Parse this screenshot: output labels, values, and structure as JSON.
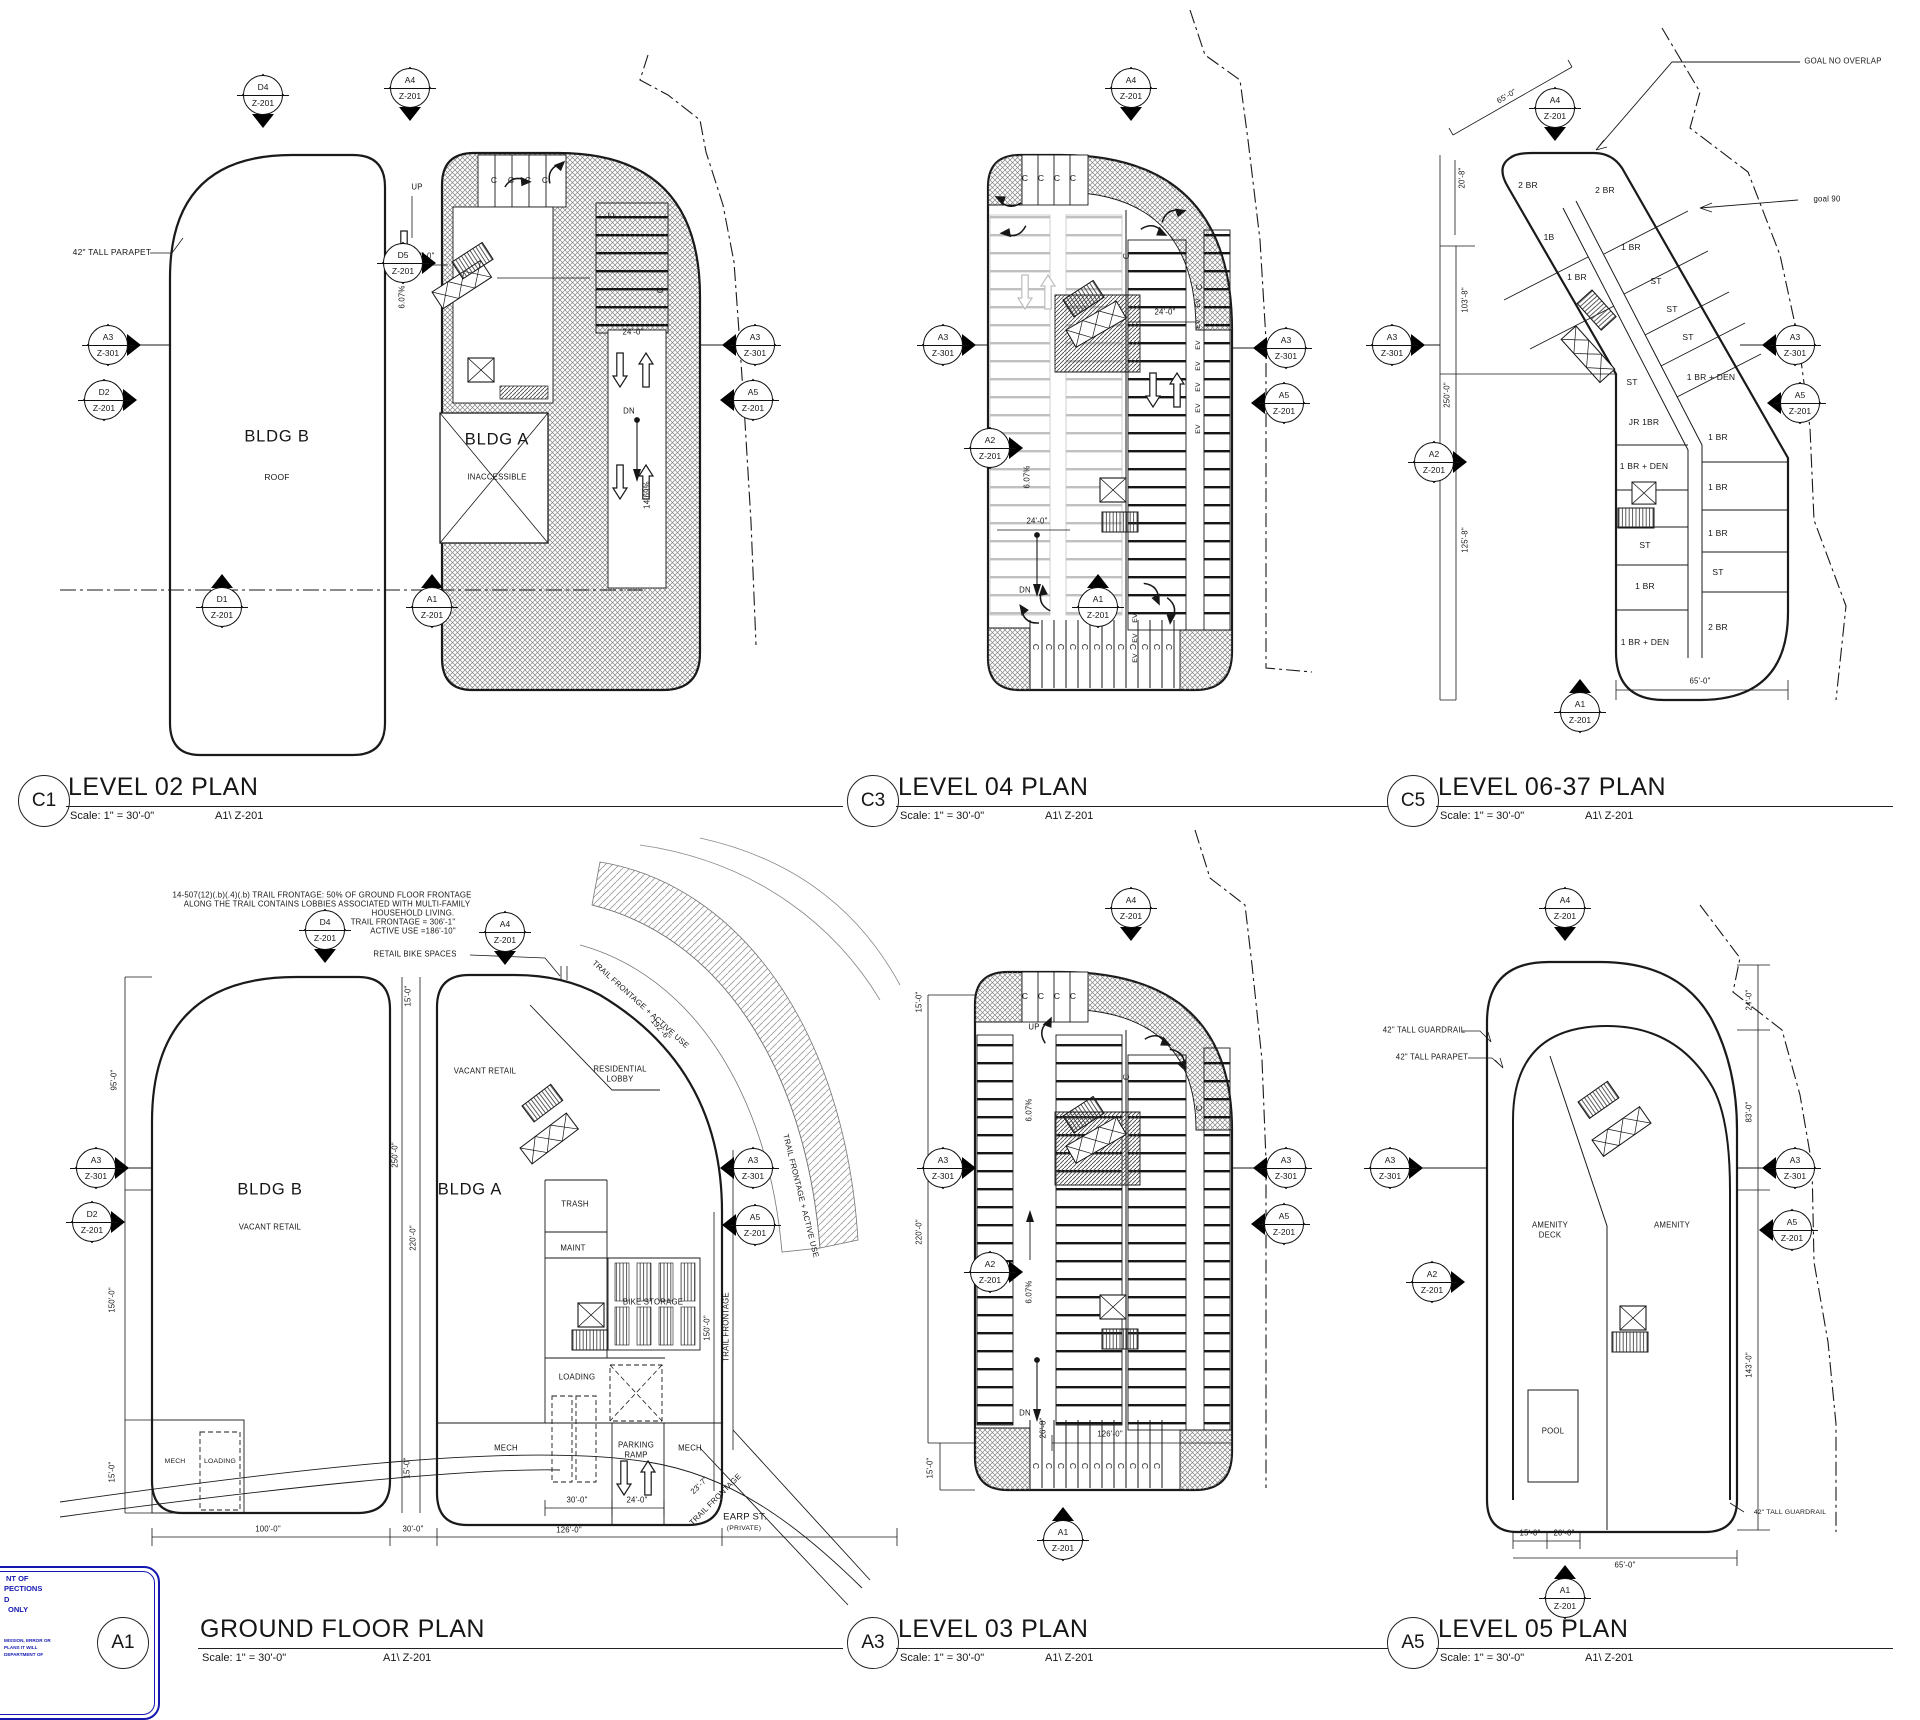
{
  "sheet": {
    "line_color": "#1a1a1a",
    "bg": "#ffffff",
    "stamp_color": "#1418b0"
  },
  "glyph": {
    "c": "C",
    "ev": "EV"
  },
  "mk": {
    "a1": "A1",
    "a2": "A2",
    "a3": "A3",
    "a4": "A4",
    "a5": "A5",
    "d1": "D1",
    "d2": "D2",
    "d4": "D4",
    "d5": "D5",
    "z201": "Z-201",
    "z301": "Z-301"
  },
  "titles": {
    "c1": {
      "tag": "C1",
      "title": "LEVEL 02 PLAN",
      "scale": "Scale: 1\" = 30'-0\"",
      "ref": "A1\\ Z-201"
    },
    "c3": {
      "tag": "C3",
      "title": "LEVEL 04 PLAN",
      "scale": "Scale: 1\" = 30'-0\"",
      "ref": "A1\\ Z-201"
    },
    "c5": {
      "tag": "C5",
      "title": "LEVEL 06-37 PLAN",
      "scale": "Scale: 1\" = 30'-0\"",
      "ref": "A1\\ Z-201"
    },
    "a1": {
      "tag": "A1",
      "title": "GROUND FLOOR PLAN",
      "scale": "Scale: 1\" = 30'-0\"",
      "ref": "A1\\ Z-201"
    },
    "a3": {
      "tag": "A3",
      "title": "LEVEL 03 PLAN",
      "scale": "Scale: 1\" = 30'-0\"",
      "ref": "A1\\ Z-201"
    },
    "a5": {
      "tag": "A5",
      "title": "LEVEL 05 PLAN",
      "scale": "Scale: 1\" = 30'-0\"",
      "ref": "A1\\ Z-201"
    }
  },
  "l02": {
    "bldg_b": "BLDG B",
    "roof": "ROOF",
    "bldg_a": "BLDG A",
    "inaccessible": "INACCESSIBLE",
    "parapet": "42\" TALL PARAPET",
    "up": "UP",
    "dn": "DN",
    "dim24": "24'-0\"",
    "slope": "6.07%",
    "slope2": "14.69%"
  },
  "l04": {
    "dim24": "24'-0\"",
    "slope": "6.07%",
    "dn": "DN"
  },
  "l0637": {
    "units": [
      "2 BR",
      "2 BR",
      "1B",
      "1 BR",
      "1 BR",
      "ST",
      "ST",
      "ST",
      "ST",
      "1 BR + DEN",
      "JR 1BR",
      "1 BR",
      "1 BR + DEN",
      "1 BR",
      "ST",
      "1 BR",
      "1 BR",
      "ST",
      "1 BR + DEN",
      "2 BR"
    ],
    "goal_overlap": "GOAL NO OVERLAP",
    "goal90": "goal 90",
    "dim65": "65'-0\"",
    "dim208": "20'-8\"",
    "dim1038": "103'-8\"",
    "dim250": "250'-0\"",
    "dim1258": "125'-8\"",
    "dim65b": "65'-0\""
  },
  "gf": {
    "note1": "14-507(12)(.b)(.4)(.b) TRAIL FRONTAGE: 50%  OF GROUND FLOOR FRONTAGE",
    "note2": "ALONG THE TRAIL CONTAINS LOBBIES ASSOCIATED WITH MULTI-FAMILY",
    "note3": "HOUSEHOLD LIVING.",
    "note4": "TRAIL FRONTAGE =  306'-1\"",
    "note5": "ACTIVE USE =186'-10\"",
    "retail_bike": "RETAIL BIKE SPACES",
    "bldg_b": "BLDG B",
    "bldg_a": "BLDG A",
    "vacant_retail": "VACANT RETAIL",
    "res1": "RESIDENTIAL",
    "res2": "LOBBY",
    "trash": "TRASH",
    "maint": "MAINT",
    "bike": "BIKE STORAGE",
    "loading": "LOADING",
    "ramp1": "PARKING",
    "ramp2": "RAMP",
    "mech": "MECH",
    "earp1": "EARP ST.",
    "earp2": "(PRIVATE)",
    "trail": "TRAIL FRONTAGE",
    "trail_active": "TRAIL FRONTAGE + ACTIVE USE",
    "dim95": "95'-0\"",
    "dim150": "150'-0\"",
    "dim15": "15'-0\"",
    "dim100": "100'-0\"",
    "dim30": "30'-0\"",
    "dim126": "126'-0\"",
    "dim250": "250'-0\"",
    "dim220": "220'-0\"",
    "dim24": "24'-0\"",
    "dim237": "23'-7\"",
    "dim1926": "192'-6\""
  },
  "l03": {
    "up": "UP",
    "dn": "DN",
    "slope": "6.07%",
    "dim268": "26'-8\"",
    "dim126": "126'-0\"",
    "dim220": "220'-0\"",
    "dim15": "15'-0\""
  },
  "l05": {
    "guardrail": "42\" TALL GUARDRAIL",
    "parapet": "42\" TALL PARAPET",
    "deck1": "AMENITY",
    "deck2": "DECK",
    "amenity": "AMENITY",
    "pool": "POOL",
    "dim24": "24'-0\"",
    "dim83": "83'-0\"",
    "dim143": "143'-0\"",
    "dim15": "15'-0\"",
    "dim20": "20'-0\"",
    "dim65": "65'-0\""
  },
  "stamp": {
    "l1": "NT OF",
    "l2": "PECTIONS",
    "l3": "D",
    "l4": "ONLY",
    "s1": "MISSION, ERROR OR",
    "s2": "PLANS IT WILL",
    "s3": "DEPARTMENT OF"
  }
}
